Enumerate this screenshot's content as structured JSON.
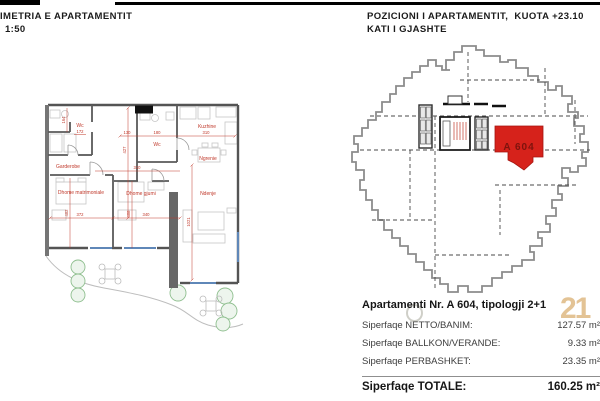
{
  "header": {
    "plan_title": "IMETRIA E APARTAMENTIT",
    "plan_scale": "1:50",
    "position_title_line1": "POZICIONI I APARTAMENTIT,  KUOTA +23.10",
    "position_title_line2": "KATI I GJASHTE"
  },
  "floor_plan": {
    "room_labels": [
      "Wc",
      "Kuzhine",
      "Wc",
      "Ngrenie",
      "Garderobe",
      "Ndenje",
      "Dhome matrimoniale",
      "Dhome gjumi"
    ],
    "dim_labels": [
      "164",
      "172",
      "130",
      "180",
      "310",
      "427",
      "310",
      "402",
      "408",
      "372",
      "340",
      "1021"
    ]
  },
  "position_plan": {
    "apartment_label": "A 604",
    "highlight_color": "#d6221b"
  },
  "summary": {
    "rows": [
      {
        "label": "Apartamenti Nr. A 604,  tipologji 2+1",
        "value": ""
      },
      {
        "label": "Siperfaqe NETTO/BANIM:",
        "value": "127.57 m²"
      },
      {
        "label": "Siperfaqe BALLKON/VERANDE:",
        "value": "9.33 m²"
      },
      {
        "label": "Siperfaqe PERBASHKET:",
        "value": "23.35 m²"
      },
      {
        "label": "Siperfaqe TOTALE:",
        "value": "160.25 m²"
      }
    ],
    "watermark_text": "21"
  }
}
